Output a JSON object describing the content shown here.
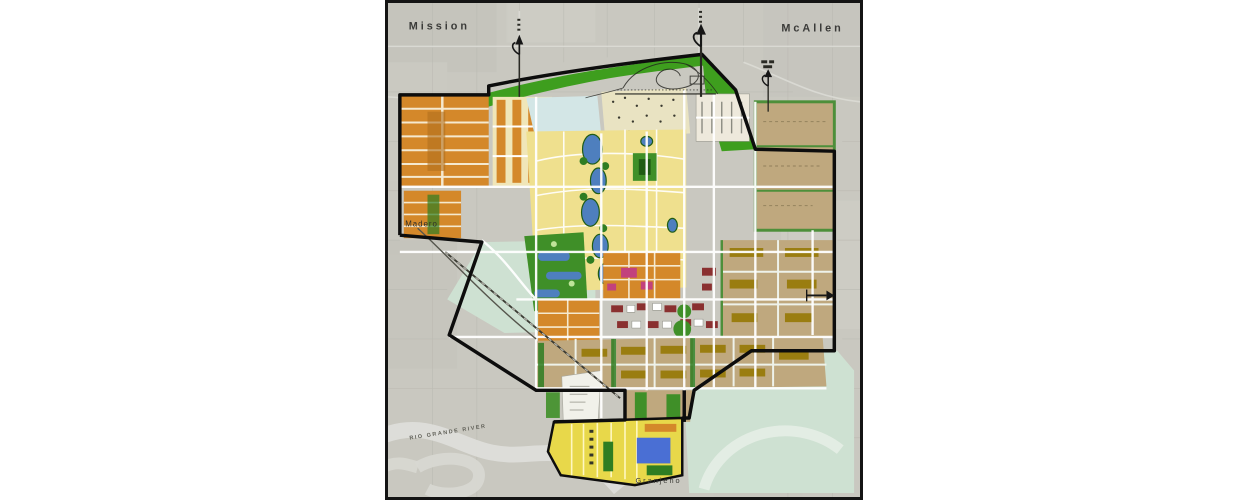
{
  "map": {
    "kind": "land-use-master-plan-over-aerial-photo",
    "labels": {
      "city_left": "Mission",
      "city_right": "McAllen",
      "community_west": "Madero",
      "community_south": "Granjeno",
      "river": "RIO GRANDE RIVER"
    },
    "colors": {
      "aerial_background": "#c9c8c0",
      "aerial_patch": "#bfbfb6",
      "aerial_road": "#dededa",
      "greenbelt": "#3e9e1e",
      "park_green": "#2f7d22",
      "golf_green": "#3f8f28",
      "floodway_mint": "#cfe3d3",
      "residential_yellow": "#efe08e",
      "residential_cream": "#f0e6b8",
      "estate_cream": "#e9e3c2",
      "district_orange": "#d4882a",
      "superblock_tan": "#bfa87e",
      "lake_blue": "#4e7fbe",
      "pool_blue": "#4a6fd4",
      "civic_red": "#8a3030",
      "accent_magenta": "#c2417d",
      "olive_building": "#9a7d10",
      "village_yellow": "#e8d84a",
      "pale_blue_district": "#d3e6e6",
      "white_site": "#f1f1ea",
      "road_white": "#ffffff",
      "boundary_black": "#0d0d0d",
      "river_gray": "#dededa"
    },
    "arrows": {
      "north_count": 3,
      "east_count": 1
    }
  }
}
